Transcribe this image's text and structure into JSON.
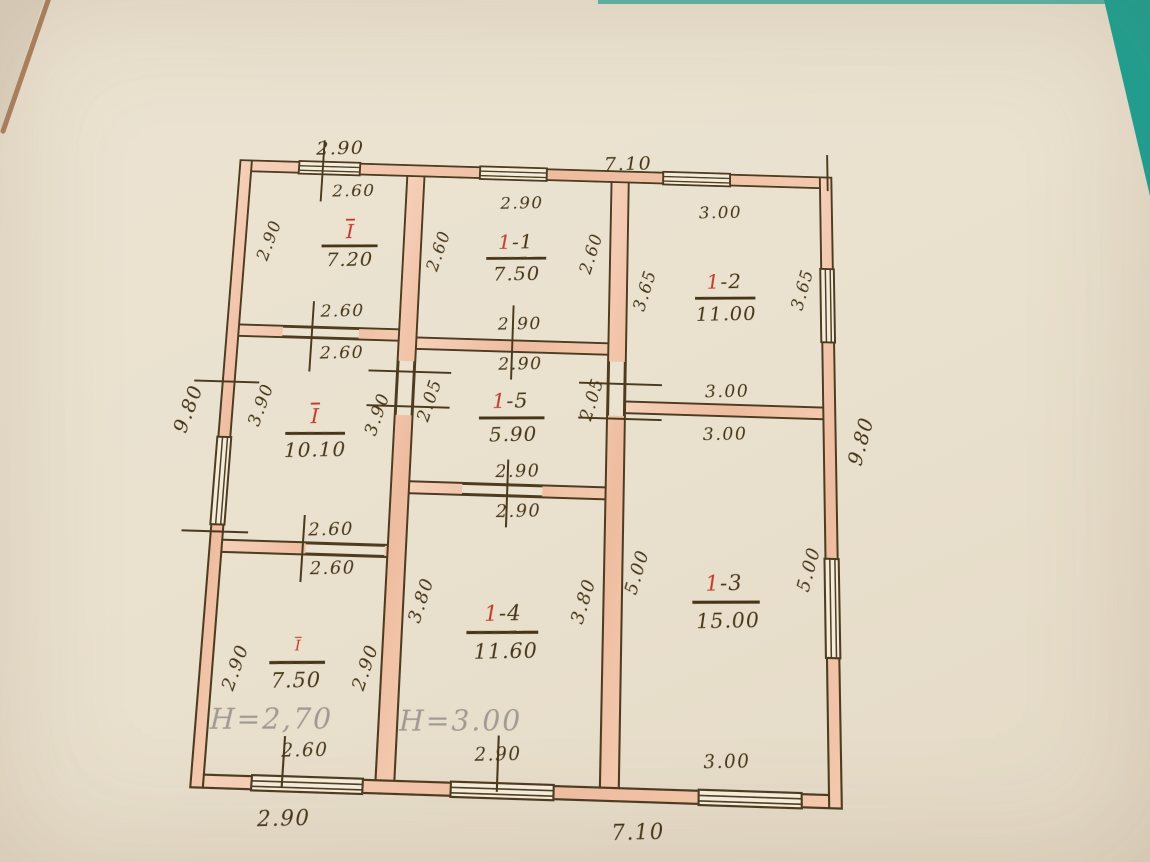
{
  "colors": {
    "paper": "#eae1cf",
    "desk_teal": "#1ca395",
    "wall_fill": "#f2c6ac",
    "ink": "#4a3a1e",
    "room_number_red": "#c23b2c",
    "pencil": "#a09a93"
  },
  "rooms": {
    "tl": {
      "num": "I",
      "rest": "",
      "area": "7.20"
    },
    "r11": {
      "num": "1",
      "rest": "-1",
      "area": "7.50"
    },
    "r12": {
      "num": "1",
      "rest": "-2",
      "area": "11.00"
    },
    "mid": {
      "num": "I",
      "rest": "",
      "area": "10.10"
    },
    "r15": {
      "num": "1",
      "rest": "-5",
      "area": "5.90"
    },
    "bl": {
      "num": "I",
      "rest": "",
      "area": "7.50",
      "note": "H=2,70"
    },
    "r14": {
      "num": "1",
      "rest": "-4",
      "area": "11.60",
      "note": "H=3.00"
    },
    "r13": {
      "num": "1",
      "rest": "-3",
      "area": "15.00"
    }
  },
  "dims": {
    "ext_top_left": "2.90",
    "ext_top_right": "7.10",
    "ext_bottom_left": "2.90",
    "ext_bottom_right": "7.10",
    "ext_left": "9.80",
    "ext_right": "9.80",
    "tl_top": "2.60",
    "tl_left": "2.90",
    "tl_bottom": "2.60",
    "mid_top": "2.60",
    "mid_left": "3.90",
    "mid_right": "3.90",
    "mid_bottom": "2.60",
    "bl_top": "2.60",
    "bl_left": "2.90",
    "bl_right": "2.90",
    "bl_bottom": "2.60",
    "r11_top": "2.90",
    "r11_left": "2.60",
    "r11_right": "2.60",
    "r11_bottom": "2.90",
    "r15_top": "2.90",
    "r15_left": "2.05",
    "r15_right": "2.05",
    "r15_bottom": "2.90",
    "r14_top": "2.90",
    "r14_left": "3.80",
    "r14_right": "3.80",
    "r14_bottom": "2.90",
    "r12_top": "3.00",
    "r12_left": "3.65",
    "r12_right": "3.65",
    "r12_bottom": "3.00",
    "r13_top": "3.00",
    "r13_left": "5.00",
    "r13_right": "5.00",
    "r13_bottom": "3.00"
  }
}
